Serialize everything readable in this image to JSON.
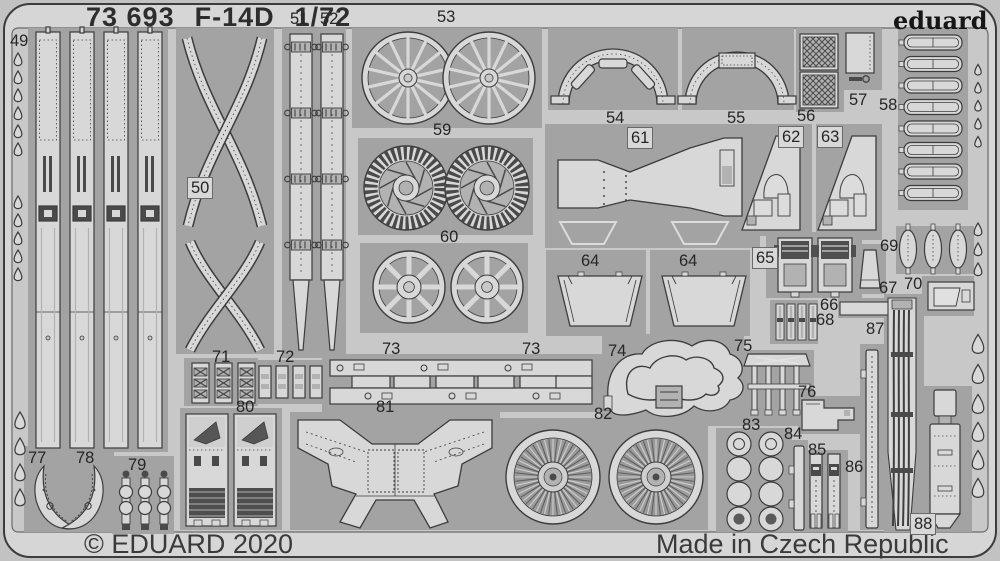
{
  "header": {
    "catalog_number": "73 693",
    "kit_name": "F-14D",
    "scale": "1/72"
  },
  "brand": {
    "logo_text": "eduard"
  },
  "footer": {
    "copyright": "© EDUARD 2020",
    "origin": "Made in Czech Republic"
  },
  "colors": {
    "photo_bg": "#c2c2c2",
    "frame": "#d6d6d6",
    "sheet": "#c8c8c8",
    "plate": "#a3a3a3",
    "part": "#d8d8d8",
    "mid": "#b2b2b2",
    "dark": "#4a4a4a",
    "outline": "#3c3c3c",
    "text": "#262626"
  },
  "sheet": {
    "labels": [
      {
        "text": "49",
        "x": 10,
        "y": 33
      },
      {
        "text": "50",
        "x": 187,
        "y": 177,
        "boxed": true
      },
      {
        "text": "51",
        "x": 290,
        "y": 11
      },
      {
        "text": "52",
        "x": 320,
        "y": 11
      },
      {
        "text": "53",
        "x": 437,
        "y": 9
      },
      {
        "text": "54",
        "x": 606,
        "y": 110
      },
      {
        "text": "55",
        "x": 727,
        "y": 110
      },
      {
        "text": "56",
        "x": 797,
        "y": 108
      },
      {
        "text": "57",
        "x": 849,
        "y": 92
      },
      {
        "text": "58",
        "x": 879,
        "y": 97
      },
      {
        "text": "59",
        "x": 433,
        "y": 122
      },
      {
        "text": "60",
        "x": 440,
        "y": 229
      },
      {
        "text": "61",
        "x": 627,
        "y": 127,
        "boxed": true
      },
      {
        "text": "62",
        "x": 778,
        "y": 126,
        "boxed": true
      },
      {
        "text": "63",
        "x": 817,
        "y": 126,
        "boxed": true
      },
      {
        "text": "64",
        "x": 581,
        "y": 253
      },
      {
        "text": "64",
        "x": 679,
        "y": 253
      },
      {
        "text": "65",
        "x": 752,
        "y": 247,
        "boxed": true
      },
      {
        "text": "66",
        "x": 820,
        "y": 297
      },
      {
        "text": "67",
        "x": 879,
        "y": 280
      },
      {
        "text": "68",
        "x": 816,
        "y": 312
      },
      {
        "text": "69",
        "x": 880,
        "y": 238
      },
      {
        "text": "70",
        "x": 904,
        "y": 276
      },
      {
        "text": "71",
        "x": 212,
        "y": 349
      },
      {
        "text": "72",
        "x": 276,
        "y": 349
      },
      {
        "text": "73",
        "x": 382,
        "y": 341
      },
      {
        "text": "73",
        "x": 522,
        "y": 341
      },
      {
        "text": "74",
        "x": 608,
        "y": 343
      },
      {
        "text": "75",
        "x": 734,
        "y": 338
      },
      {
        "text": "76",
        "x": 798,
        "y": 384
      },
      {
        "text": "77",
        "x": 28,
        "y": 450
      },
      {
        "text": "78",
        "x": 76,
        "y": 450
      },
      {
        "text": "79",
        "x": 128,
        "y": 457
      },
      {
        "text": "80",
        "x": 236,
        "y": 399
      },
      {
        "text": "81",
        "x": 376,
        "y": 399
      },
      {
        "text": "82",
        "x": 594,
        "y": 406
      },
      {
        "text": "83",
        "x": 742,
        "y": 417
      },
      {
        "text": "84",
        "x": 784,
        "y": 426
      },
      {
        "text": "85",
        "x": 808,
        "y": 442
      },
      {
        "text": "86",
        "x": 845,
        "y": 459
      },
      {
        "text": "87",
        "x": 866,
        "y": 321
      },
      {
        "text": "88",
        "x": 910,
        "y": 513,
        "boxed": true
      }
    ],
    "figures": [
      {
        "type": "rails",
        "x": 36,
        "y": 32,
        "plate": [
          28,
          28,
          140,
          424
        ]
      },
      {
        "type": "xbrace",
        "plate": [
          176,
          28,
          98,
          326
        ]
      },
      {
        "type": "belt",
        "x": 290,
        "y": 34,
        "plate": [
          282,
          28,
          64,
          330
        ]
      },
      {
        "type": "belt",
        "x": 321,
        "y": 34
      },
      {
        "type": "spokewheels",
        "items": [
          [
            408,
            78,
            46
          ],
          [
            489,
            78,
            46
          ]
        ],
        "n": 14,
        "sw": 3.2,
        "hub": 9,
        "plate": [
          352,
          28,
          190,
          100
        ]
      },
      {
        "type": "gears",
        "items": [
          [
            406,
            188,
            42
          ],
          [
            487,
            188,
            42
          ]
        ],
        "plate": [
          358,
          138,
          175,
          97
        ]
      },
      {
        "type": "spokewheels",
        "items": [
          [
            409,
            287,
            36
          ],
          [
            487,
            287,
            36
          ]
        ],
        "n": 8,
        "sw": 5,
        "hub": 12,
        "plate": [
          360,
          243,
          168,
          90
        ]
      },
      {
        "type": "arch",
        "cx": 613,
        "cy": 104,
        "R": 55,
        "variant": "slots",
        "plate": [
          548,
          28,
          130,
          82
        ]
      },
      {
        "type": "arch",
        "cx": 737,
        "cy": 104,
        "R": 52,
        "variant": "tab",
        "plate": [
          682,
          28,
          112,
          82
        ]
      },
      {
        "type": "mesh",
        "items": [
          [
            800,
            34,
            38,
            36
          ],
          [
            800,
            72,
            38,
            36
          ]
        ],
        "plate": [
          796,
          28,
          48,
          84
        ]
      },
      {
        "type": "panelkey",
        "plate": [
          842,
          28,
          40,
          62
        ]
      },
      {
        "type": "ladder",
        "x": 904,
        "y": 35,
        "n": 8,
        "pitch": 21.5,
        "w": 58,
        "h": 15,
        "plate": [
          898,
          28,
          70,
          182
        ]
      },
      {
        "type": "bowtie",
        "plate": [
          545,
          124,
          215,
          124
        ]
      },
      {
        "type": "console",
        "x": 742,
        "y": 136,
        "plate": [
          738,
          124,
          74,
          112
        ]
      },
      {
        "type": "console",
        "x": 818,
        "y": 136,
        "plate": [
          816,
          124,
          66,
          116
        ]
      },
      {
        "type": "trap64",
        "x": 558,
        "y": 276,
        "plate": [
          546,
          250,
          100,
          86
        ]
      },
      {
        "type": "trap64",
        "x": 662,
        "y": 276,
        "plate": [
          650,
          250,
          100,
          86
        ]
      },
      {
        "type": "seats",
        "plate": [
          766,
          232,
          96,
          66
        ]
      },
      {
        "type": "cone",
        "plate": [
          856,
          244,
          30,
          50
        ]
      },
      {
        "type": "smallstrips",
        "x": 776,
        "y": 304,
        "n": 4,
        "pitch": 11,
        "plate": [
          770,
          300,
          48,
          44
        ]
      },
      {
        "type": "pods",
        "cy": 249,
        "xs": [
          908,
          933,
          958
        ],
        "plate": [
          896,
          226,
          78,
          48
        ]
      },
      {
        "type": "rect70",
        "plate": [
          922,
          276,
          52,
          40
        ]
      },
      {
        "type": "buckles",
        "x": 192,
        "y": 363,
        "n": 3,
        "pitch": 23,
        "plate": [
          184,
          358,
          74,
          48
        ]
      },
      {
        "type": "pieces72",
        "x": 259,
        "y": 366,
        "n": 4,
        "pitch": 17,
        "plate": [
          254,
          360,
          70,
          44
        ]
      },
      {
        "type": "notchstrips",
        "plate": [
          322,
          354,
          282,
          58
        ]
      },
      {
        "type": "blob74",
        "plate": [
          602,
          334,
          142,
          92
        ]
      },
      {
        "type": "legs75",
        "plate": [
          744,
          350,
          70,
          76
        ]
      },
      {
        "type": "L76",
        "plate": [
          798,
          396,
          62,
          38
        ]
      },
      {
        "type": "horns",
        "plate": [
          24,
          446,
          90,
          86
        ]
      },
      {
        "type": "circstrips",
        "x": 120,
        "y": 472,
        "n": 3,
        "pitch": 19,
        "plate": [
          112,
          456,
          62,
          78
        ]
      },
      {
        "type": "panels80",
        "plate": [
          180,
          408,
          102,
          122
        ]
      },
      {
        "type": "wingpanel",
        "plate": [
          290,
          412,
          210,
          118
        ]
      },
      {
        "type": "finefans",
        "items": [
          [
            553,
            477,
            47
          ],
          [
            656,
            477,
            47
          ]
        ],
        "plate": [
          492,
          418,
          216,
          112
        ]
      },
      {
        "type": "circgrid",
        "plate": [
          716,
          428,
          76,
          104
        ]
      },
      {
        "type": "thinstrip",
        "x": 794,
        "y": 446,
        "w": 10,
        "h": 84,
        "dots": false,
        "plate": [
          790,
          440,
          18,
          92
        ]
      },
      {
        "type": "belts85",
        "plate": [
          806,
          450,
          42,
          82
        ]
      },
      {
        "type": "thinstrip",
        "x": 866,
        "y": 350,
        "w": 12,
        "h": 178,
        "dots": true,
        "plate": [
          860,
          344,
          26,
          186
        ]
      },
      {
        "type": "cables",
        "plate": [
          884,
          294,
          40,
          238
        ]
      },
      {
        "type": "probe",
        "plate": [
          924,
          386,
          48,
          146
        ]
      }
    ],
    "drops_left": [
      {
        "x": 18,
        "ys": [
          62,
          80,
          98,
          116,
          134,
          152
        ],
        "s": 6
      },
      {
        "x": 18,
        "ys": [
          205,
          223,
          241,
          259,
          277
        ],
        "s": 6
      },
      {
        "x": 20,
        "ys": [
          424,
          450,
          476,
          501
        ],
        "s": 8
      }
    ],
    "drops_right": [
      {
        "x": 978,
        "ys": [
          72,
          90,
          108,
          126,
          144
        ],
        "s": 5
      },
      {
        "x": 978,
        "ys": [
          232,
          252,
          272
        ],
        "s": 6
      },
      {
        "x": 978,
        "ys": [
          348,
          378,
          408
        ],
        "s": 9
      },
      {
        "x": 978,
        "ys": [
          436,
          464,
          492
        ],
        "s": 9
      }
    ]
  }
}
